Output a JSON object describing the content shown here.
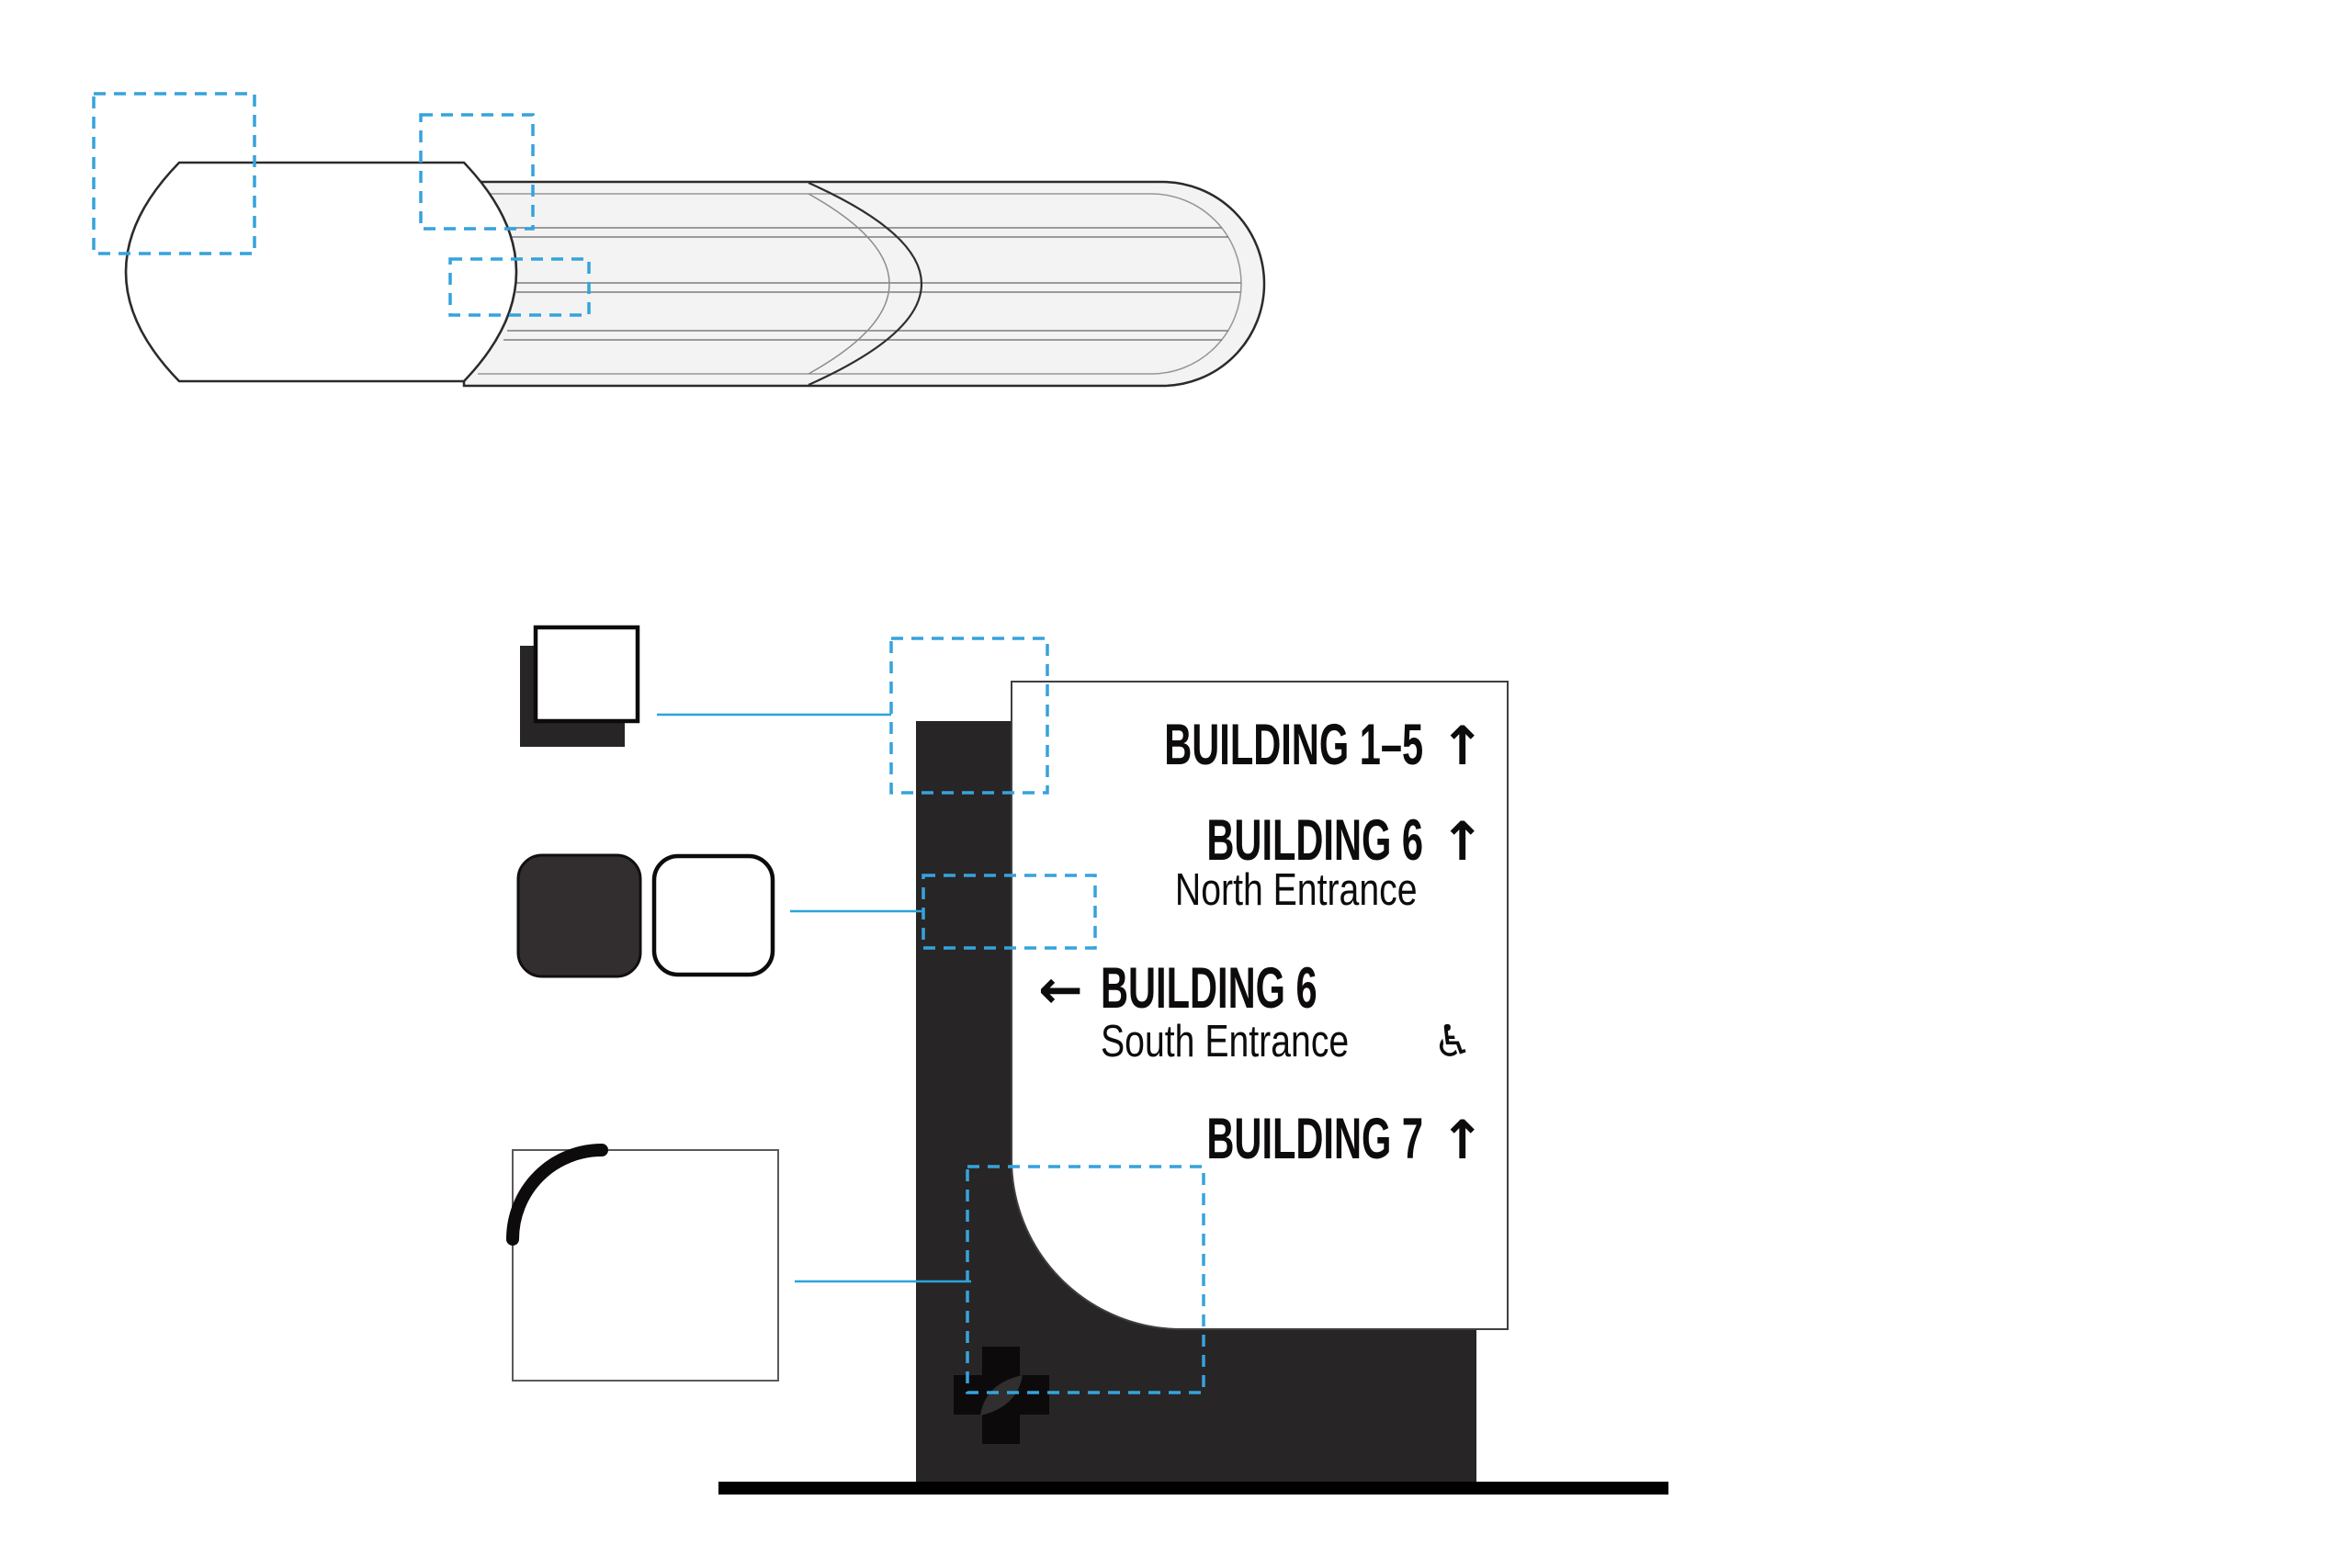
{
  "sign_panel": {
    "rows": [
      {
        "label": "BUILDING 1–5",
        "arrow": "↑"
      },
      {
        "label": "BUILDING 6",
        "arrow": "↑",
        "sublabel": "North Entrance"
      },
      {
        "label": "BUILDING 6",
        "arrow": "←",
        "sublabel": "South Entrance",
        "access_symbol": "♿"
      },
      {
        "label": "BUILDING 7",
        "arrow": "↑"
      }
    ]
  },
  "colors": {
    "callout_blue": "#35a3dc",
    "connector_blue": "#29a4dc",
    "charcoal": "#282526",
    "logo_black": "#0c0a0b",
    "logo_leaf": "#312e2f",
    "body_gray": "#f3f3f3",
    "outline_dark": "#2b2b2b",
    "panel_border": "#3f3f3f",
    "ground_black": "#000000"
  }
}
